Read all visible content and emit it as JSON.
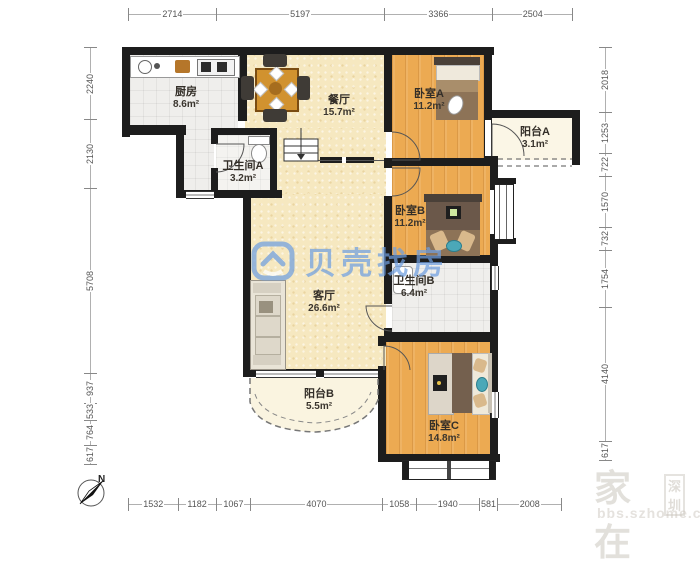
{
  "brand_watermark": {
    "logo": "beike-shell-logo",
    "text": "贝壳找房"
  },
  "corner_watermark": {
    "name": "家在",
    "city_badge": "深圳",
    "site": "bbs.szhome.com"
  },
  "compass": {
    "north_label": "N"
  },
  "rooms": [
    {
      "name": "厨房",
      "area": "8.6m²"
    },
    {
      "name": "餐厅",
      "area": "15.7m²"
    },
    {
      "name": "卧室A",
      "area": "11.2m²"
    },
    {
      "name": "阳台A",
      "area": "3.1m²"
    },
    {
      "name": "卫生间A",
      "area": "3.2m²"
    },
    {
      "name": "卧室B",
      "area": "11.2m²"
    },
    {
      "name": "卫生间B",
      "area": "6.4m²"
    },
    {
      "name": "客厅",
      "area": "26.6m²"
    },
    {
      "name": "阳台B",
      "area": "5.5m²"
    },
    {
      "name": "卧室C",
      "area": "14.8m²"
    }
  ],
  "dimensions_mm": {
    "top": [
      2714,
      5197,
      3366,
      2504
    ],
    "bottom": [
      1532,
      1182,
      1067,
      4070,
      1058,
      1940,
      581,
      2008
    ],
    "left": [
      2240,
      2130,
      5708,
      937,
      533,
      764,
      617
    ],
    "right": [
      2018,
      1253,
      722,
      1570,
      732,
      1754,
      4140,
      617
    ]
  },
  "colors": {
    "wall": "#1d1d1d",
    "wood_floor": "#ecaa52",
    "tile_floor": "#efeeec",
    "warm_floor": "#f6e8c0",
    "balcony_floor": "#fbf6e6",
    "watermark_blue": "#6f9fe0"
  }
}
